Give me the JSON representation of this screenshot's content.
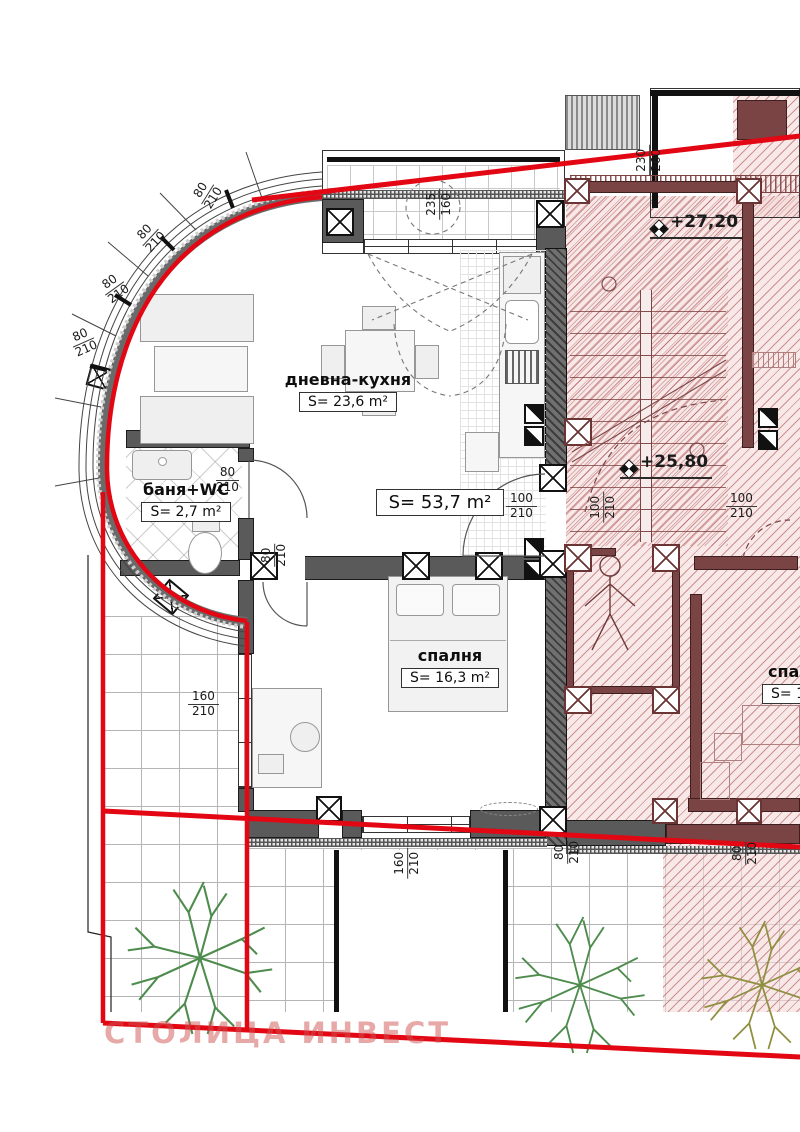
{
  "watermark": "СТОЛИЦА ИНВЕСТ",
  "rooms": {
    "living": {
      "name": "дневна-кухня",
      "area": "S= 23,6 m²"
    },
    "apartment_total": {
      "area": "S= 53,7 m²"
    },
    "bath": {
      "name": "баня+WC",
      "area": "S= 2,7 m²"
    },
    "bedroom": {
      "name": "спалня",
      "area": "S= 16,3 m²"
    },
    "neighbor": {
      "name": "спа",
      "area": "S= 1"
    }
  },
  "levels": {
    "upper": "+27,20",
    "lower": "+25,80"
  },
  "dims": [
    {
      "a": "80",
      "b": "210"
    },
    {
      "a": "80",
      "b": "210"
    },
    {
      "a": "80",
      "b": "210"
    },
    {
      "a": "80",
      "b": "210"
    },
    {
      "a": "235",
      "b": "160"
    },
    {
      "a": "230",
      "b": "260"
    },
    {
      "a": "80",
      "b": "210"
    },
    {
      "a": "80",
      "b": "210"
    },
    {
      "a": "100",
      "b": "210"
    },
    {
      "a": "100",
      "b": "210"
    },
    {
      "a": "100",
      "b": "210"
    },
    {
      "a": "160",
      "b": "210"
    },
    {
      "a": "160",
      "b": "210"
    },
    {
      "a": "80",
      "b": "210"
    },
    {
      "a": "80",
      "b": "210"
    }
  ],
  "colors": {
    "boundary_red": "#e30613",
    "hatch_red": "#a84848",
    "wall_gray": "#5a5a5a",
    "maroon_wall": "#7a4444",
    "tree_green": "#4e8c4e",
    "tree_olive": "#8f8f3f",
    "watermark_red": "#cf5252"
  }
}
